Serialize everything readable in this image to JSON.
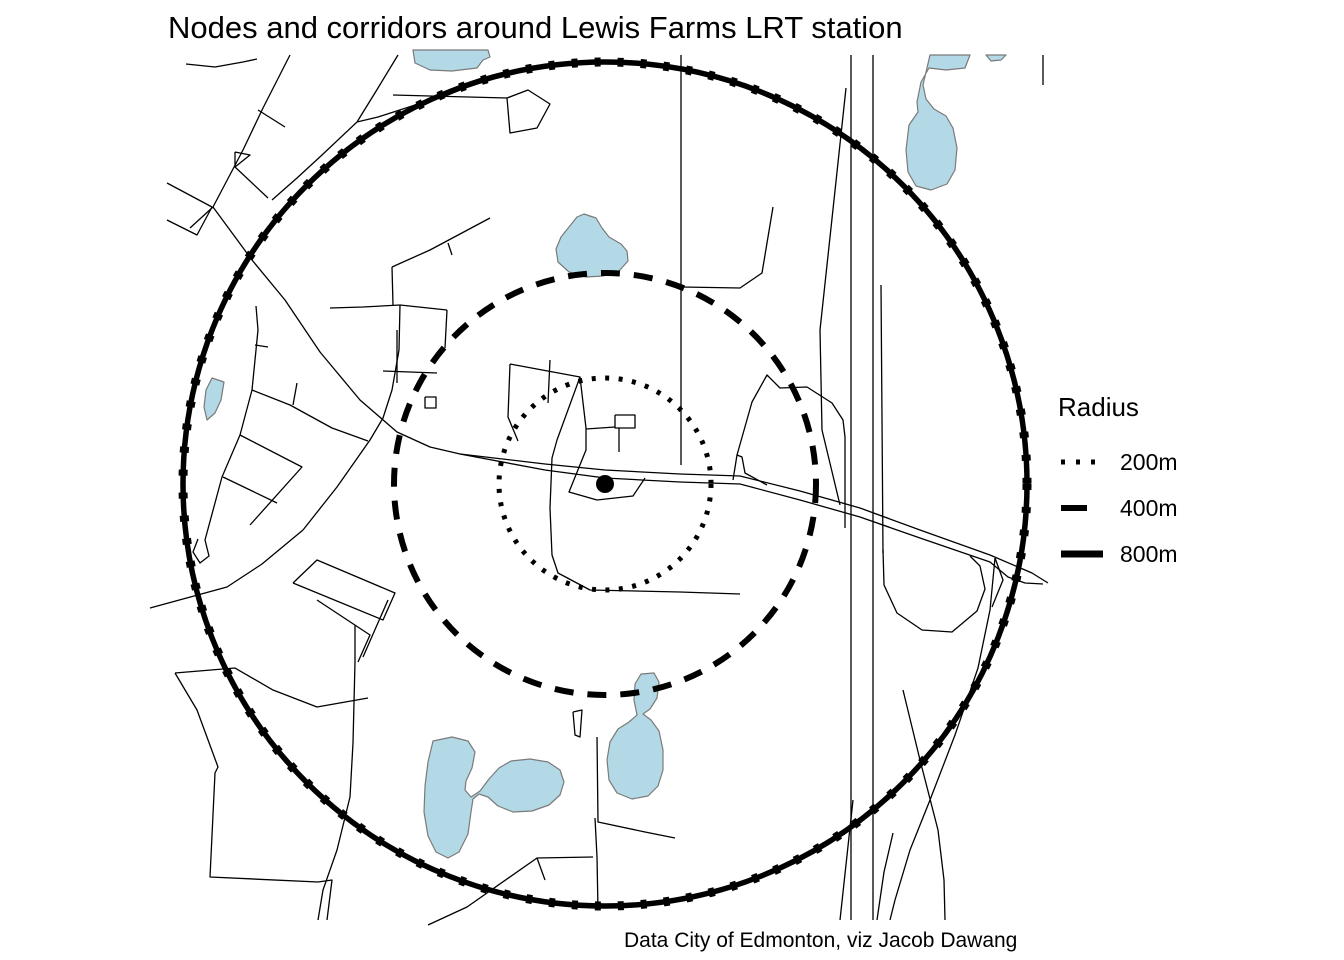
{
  "title": "Nodes and corridors around Lewis Farms LRT station",
  "caption": "Data City of Edmonton, viz Jacob Dawang",
  "legend": {
    "title": "Radius",
    "items": [
      {
        "label": "200m",
        "style": "dotted"
      },
      {
        "label": "400m",
        "style": "dashed"
      },
      {
        "label": "800m",
        "style": "solid"
      }
    ]
  },
  "map": {
    "center": {
      "x": 605,
      "y": 484
    },
    "station_dot_radius": 9,
    "circles": [
      {
        "radius_label": "200m",
        "r": 106,
        "style": "dotted"
      },
      {
        "radius_label": "400m",
        "r": 211,
        "style": "dashed"
      },
      {
        "radius_label": "800m",
        "r": 422,
        "style": "solid"
      }
    ],
    "colors": {
      "background": "#ffffff",
      "road": "#000000",
      "circle": "#000000",
      "water_fill": "#b3d9e6",
      "water_stroke": "#7a7a7a"
    },
    "roads": [
      "186,64 215,67 243,62 257,59",
      "290,55 263,108 243,150 213,207 190,228",
      "258,110 285,127",
      "167,183 212,207",
      "167,220 197,235 212,207",
      "213,207 252,260 285,300 320,352 360,400 397,432 430,447 460,454",
      "256,306 258,330 252,390 240,435 222,477 205,540 209,556 200,563 193,552 198,539",
      "255,345 268,347",
      "240,435 302,467 250,525",
      "223,477 277,503",
      "252,390 290,405 332,428 368,441",
      "293,405 297,383",
      "398,55 378,88 357,122",
      "487,79 448,95 412,106 378,117 357,122",
      "357,122 322,155 297,178 272,200",
      "393,95 430,96 507,98",
      "507,98 528,90 550,104 537,128 510,133 507,98",
      "235,152 250,155 235,167 235,152",
      "235,167 268,198",
      "330,308 363,307 400,305 447,310",
      "447,310 445,348",
      "392,267 393,305",
      "392,267 430,250 490,218",
      "448,243 452,255",
      "397,330 397,383",
      "383,371 437,373",
      "425,397 436,397 436,408 425,408 425,397",
      "400,305 399,350 392,390 383,418 370,440 337,487 303,530 262,564 227,587 150,608",
      "681,55 681,465",
      "773,207 762,273 740,288 682,287",
      "851,55 851,920",
      "873,55 873,920",
      "881,285 883,553",
      "846,88 834,200 820,330 822,430 840,505",
      "853,800 840,920",
      "893,833 884,872 877,920",
      "883,550 884,585 897,613 922,630 952,632 977,611 985,589 980,566 970,556",
      "995,558 990,610 978,668 955,735 930,800 910,850 895,900 890,920",
      "903,690 920,760 938,830 944,880 945,920",
      "733,480 737,455 752,402 767,375 780,388 807,387 832,403 843,420 845,437 845,528",
      "737,455 742,457 745,473 767,485",
      "460,454 545,464 605,470 680,474 740,476 800,491 860,508 920,530 990,555 1032,573 1048,583",
      "460,454 545,470 605,478 680,482 740,484 800,500 860,517 920,538 990,562 1008,577 1025,583 1043,584",
      "995,558 1003,580 992,607",
      "586,428 586,450 569,492 597,500 633,496 645,478",
      "586,429 615,427",
      "615,415 635,415 635,428 615,428 615,415",
      "619,428 619,452",
      "510,364 580,377 586,428",
      "510,364 508,417 518,441",
      "550,360 548,403",
      "580,377 557,440 552,458 550,508 552,555 558,573 590,590 680,592 740,594",
      "175,673 235,668 273,690 317,707 368,698",
      "175,673 197,710 218,767 215,773 210,877 318,882 332,880 327,920",
      "355,625 355,662 353,743 350,797 337,850 323,890 318,920",
      "317,600 370,635 358,662",
      "388,600 363,657",
      "293,583 317,560 395,593 383,620 293,583",
      "428,925 467,907 537,858 593,857",
      "537,858 545,880",
      "595,818 597,857 598,910",
      "573,712 582,710 580,737 575,735 573,712",
      "597,737 598,822 645,832 675,838",
      "1043,55 1043,85"
    ],
    "lakes": [
      "413,50 488,50 490,57 483,60 477,68 452,71 430,70 415,63",
      "930,55 970,55 965,68 946,70 929,68 921,82 917,102 918,112 909,125 906,150 908,172 916,186 931,190 947,184 955,170 957,148 953,128 946,116 934,109 926,99 923,85",
      "986,55 1006,55 1001,60 991,61",
      "212,378 224,382 221,400 215,413 207,420 204,407 206,390",
      "584,214 596,218 602,228 609,237 621,244 627,251 628,261 619,271 603,276 586,277 569,272 558,262 556,249 561,237 569,227 577,217",
      "433,741 452,737 468,741 475,752 472,768 466,781 465,790 471,797 480,791 489,779 499,768 511,761 530,759 548,762 560,770 564,782 560,795 549,805 532,811 513,812 498,806 488,797 479,794 473,799 471,812 468,834 459,852 448,858 436,852 428,836 424,812 425,786 428,762",
      "641,674 654,673 659,682 657,698 650,709 643,714 651,720 659,731 663,750 663,770 658,786 648,796 632,799 617,793 609,780 607,760 610,742 618,729 629,722 637,715 634,700 635,684"
    ]
  }
}
